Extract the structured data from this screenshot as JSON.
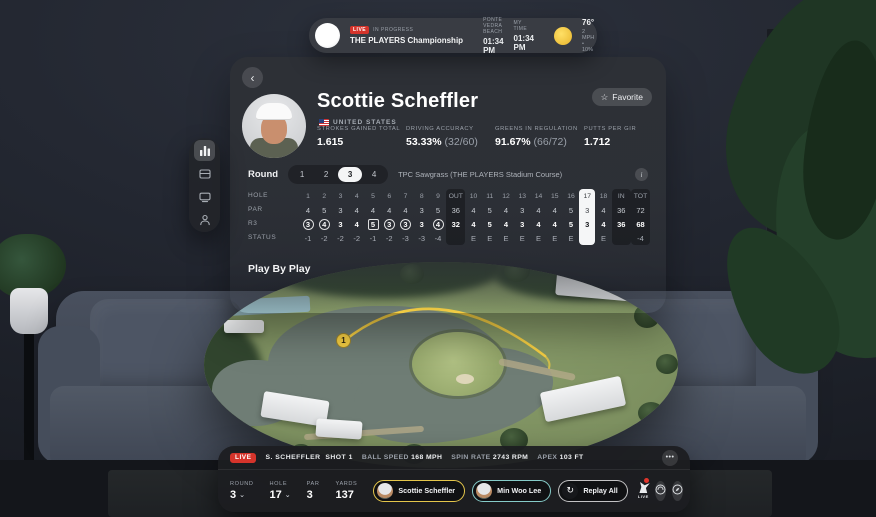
{
  "icons": {
    "back": "‹",
    "favorite_star": "☆",
    "more": "•••",
    "chevron_down": "⌄",
    "replay": "↻",
    "info": "i"
  },
  "top_bar": {
    "live_badge": "LIVE",
    "status": "IN PROGRESS",
    "tournament": "THE PLAYERS Championship",
    "location_label": "PONTE VEDRA BEACH",
    "location_time": "01:34 PM",
    "my_time_label": "MY TIME",
    "my_time": "01:34 PM",
    "temperature": "76°",
    "weather_detail": "2 MPH • 10%"
  },
  "sidebar": {
    "items": [
      "leaderboard",
      "scorecards",
      "watch",
      "players"
    ]
  },
  "player_panel": {
    "name": "Scottie Scheffler",
    "country": "UNITED STATES",
    "favorite_label": "Favorite",
    "stats": [
      {
        "label": "STROKES GAINED TOTAL",
        "value": "1.615",
        "extra": ""
      },
      {
        "label": "DRIVING ACCURACY",
        "value": "53.33%",
        "extra": "(32/60)"
      },
      {
        "label": "GREENS IN REGULATION",
        "value": "91.67%",
        "extra": "(66/72)"
      },
      {
        "label": "PUTTS PER GIR",
        "value": "1.712",
        "extra": ""
      }
    ],
    "round_label": "Round",
    "rounds": [
      "1",
      "2",
      "3",
      "4"
    ],
    "selected_round": "3",
    "course": "TPC Sawgrass (THE PLAYERS Stadium Course)",
    "play_by_play": "Play By Play"
  },
  "scorecard": {
    "row_labels": [
      "HOLE",
      "PAR",
      "R3",
      "STATUS"
    ],
    "columns": [
      {
        "hole": "1",
        "par": "4",
        "score": "3",
        "status": "-1",
        "mark": "circle"
      },
      {
        "hole": "2",
        "par": "5",
        "score": "4",
        "status": "-2",
        "mark": "circle"
      },
      {
        "hole": "3",
        "par": "3",
        "score": "3",
        "status": "-2",
        "mark": "none"
      },
      {
        "hole": "4",
        "par": "4",
        "score": "4",
        "status": "-2",
        "mark": "none"
      },
      {
        "hole": "5",
        "par": "4",
        "score": "5",
        "status": "-1",
        "mark": "square"
      },
      {
        "hole": "6",
        "par": "4",
        "score": "3",
        "status": "-2",
        "mark": "circle"
      },
      {
        "hole": "7",
        "par": "4",
        "score": "3",
        "status": "-3",
        "mark": "circle"
      },
      {
        "hole": "8",
        "par": "3",
        "score": "3",
        "status": "-3",
        "mark": "none"
      },
      {
        "hole": "9",
        "par": "5",
        "score": "4",
        "status": "-4",
        "mark": "circle"
      },
      {
        "hole": "OUT",
        "par": "36",
        "score": "32",
        "status": "",
        "mark": "none",
        "summary": true
      },
      {
        "hole": "10",
        "par": "4",
        "score": "4",
        "status": "E",
        "mark": "none"
      },
      {
        "hole": "11",
        "par": "5",
        "score": "5",
        "status": "E",
        "mark": "none"
      },
      {
        "hole": "12",
        "par": "4",
        "score": "4",
        "status": "E",
        "mark": "none"
      },
      {
        "hole": "13",
        "par": "3",
        "score": "3",
        "status": "E",
        "mark": "none"
      },
      {
        "hole": "14",
        "par": "4",
        "score": "4",
        "status": "E",
        "mark": "none"
      },
      {
        "hole": "15",
        "par": "4",
        "score": "4",
        "status": "E",
        "mark": "none"
      },
      {
        "hole": "16",
        "par": "5",
        "score": "5",
        "status": "E",
        "mark": "none"
      },
      {
        "hole": "17",
        "par": "3",
        "score": "3",
        "status": "",
        "mark": "none",
        "current": true
      },
      {
        "hole": "18",
        "par": "4",
        "score": "4",
        "status": "E",
        "mark": "none"
      },
      {
        "hole": "IN",
        "par": "36",
        "score": "36",
        "status": "",
        "mark": "none",
        "summary": true
      },
      {
        "hole": "TOT",
        "par": "72",
        "score": "68",
        "status": "-4",
        "mark": "none",
        "summary": true
      }
    ]
  },
  "course_view": {
    "shot_marker": "1"
  },
  "shot_bar": {
    "live_badge": "LIVE",
    "player": "S. SCHEFFLER",
    "shot": "SHOT 1",
    "metrics": [
      {
        "label": "BALL SPEED",
        "value": "168 MPH"
      },
      {
        "label": "SPIN RATE",
        "value": "2743 RPM"
      },
      {
        "label": "APEX",
        "value": "103 FT"
      }
    ]
  },
  "controls": {
    "round_label": "ROUND",
    "round": "3",
    "hole_label": "HOLE",
    "hole": "17",
    "par_label": "PAR",
    "par": "3",
    "yards_label": "YARDS",
    "yards": "137",
    "players": [
      {
        "name": "Scottie Scheffler",
        "selected": true
      },
      {
        "name": "Min Woo Lee",
        "selected": false
      }
    ],
    "replay_label": "Replay All",
    "pga_live_label": "LIVE"
  },
  "colors": {
    "accent_yellow": "#f5ce43",
    "live_red": "#d5342b",
    "selected_chip_yellow": "#e4c64b",
    "alt_chip_teal": "#86ccc9",
    "current_hole_bg": "#f5f6f7"
  }
}
